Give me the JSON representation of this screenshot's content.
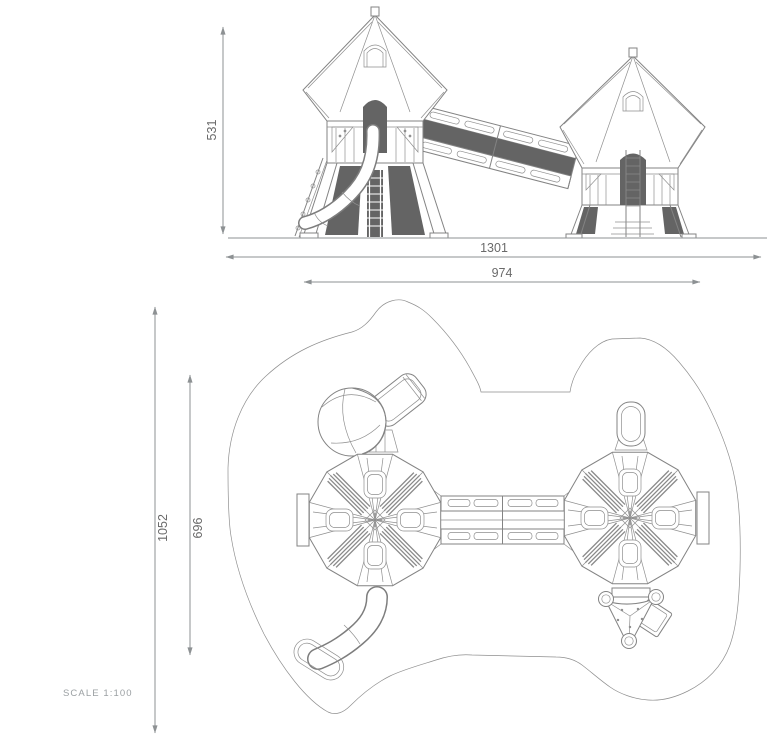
{
  "views": {
    "elevation": {
      "name": "front-elevation",
      "dims": {
        "height": "531",
        "overall_width": "1301",
        "platform_width": "974"
      }
    },
    "plan": {
      "name": "plan-view",
      "dims": {
        "overall_depth": "1052",
        "platform_depth": "696"
      }
    }
  },
  "scale": {
    "label": "SCALE 1:100"
  },
  "colors": {
    "line": "#838383",
    "dark_fill": "#646464",
    "dimension": "#8d9193",
    "dim_text": "#6a6a6a",
    "scale_text": "#9ba0a3",
    "background": "#ffffff"
  }
}
